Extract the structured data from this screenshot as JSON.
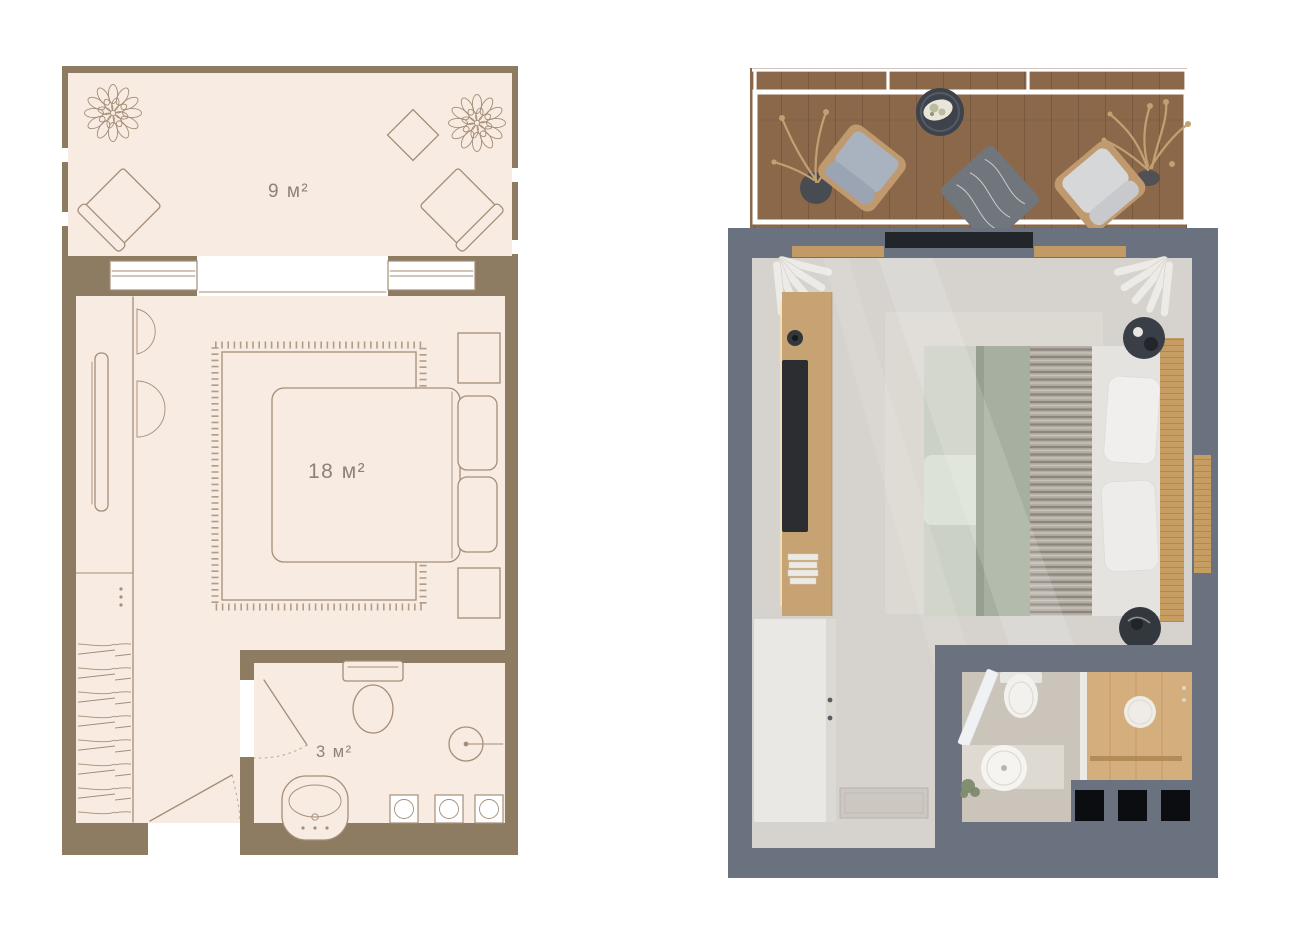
{
  "colors": {
    "bg": "#ffffff",
    "wall2d": "#8d7c61",
    "floor2d": "#f7ebe2",
    "line2d": "#a58e77",
    "label2d": "#8d8279",
    "wall3d": "#6a7280",
    "floor3d": "#d6d3ce",
    "rug3d": "#dcd8d2",
    "deck": "#8b6849",
    "deckline": "#70513a",
    "wood": "#c7a273",
    "tan": "#c69e63",
    "tv": "#2b2d31",
    "sage": "#a7b0a0",
    "sheet": "#ccd1c5",
    "pillow": "#f0efed",
    "chaircushion": "#a9b2bf",
    "chaircushion2": "#d6d7d9",
    "throw": "#71767d",
    "plantdry": "#c3a074",
    "wardrobe": "#e9e8e4",
    "stone": "#cac4bb",
    "showerwood": "#d4ae7c",
    "blackunit": "#0b0d10",
    "porcelain": "#f2f1ee",
    "counter": "#ded9d1",
    "plantgreen": "#7b8a6d",
    "curtain": "#ecebe7",
    "mat": "#ccc8c1"
  },
  "plan2d": {
    "rooms": [
      {
        "id": "balcony",
        "area_label": "9 м²"
      },
      {
        "id": "bedroom",
        "area_label": "18 м²"
      },
      {
        "id": "bathroom",
        "area_label": "3 м²"
      }
    ]
  }
}
